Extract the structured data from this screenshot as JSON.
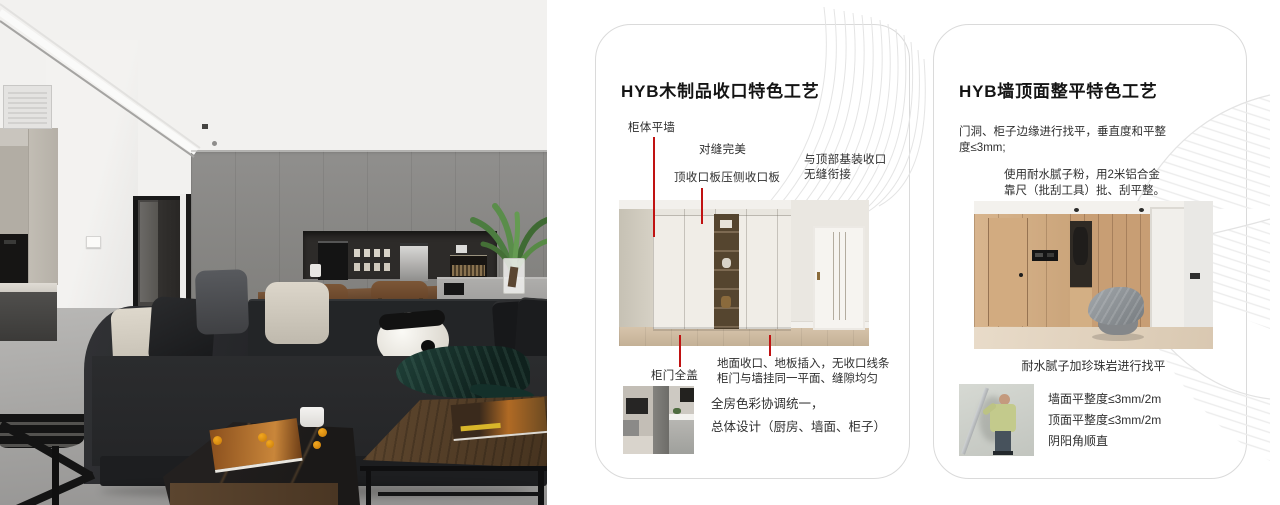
{
  "colors": {
    "accent_red": "#c01212",
    "card_border": "#dadada",
    "decor_line": "#e5e5e5"
  },
  "card1": {
    "title": "HYB木制品收口特色工艺",
    "callout_cabinet_flush_wall": "柜体平墙",
    "callout_perfect_seam": "对缝完美",
    "callout_top_closeout_panel": "顶收口板压侧收口板",
    "callout_ceiling_joint_line1": "与顶部基装收口",
    "callout_ceiling_joint_line2": "无缝衔接",
    "callout_full_overlay_door": "柜门全盖",
    "note_line1": "地面收口、地板插入，无收口线条",
    "note_line2": "柜门与墙挂同一平面、缝隙均匀",
    "summary_line1": "全房色彩协调统一，",
    "summary_line2": "总体设计（厨房、墙面、柜子）"
  },
  "card2": {
    "title": "HYB墙顶面整平特色工艺",
    "para1_line1": "门洞、柜子边缘进行找平，垂直度和平整",
    "para1_line2": "度≤3mm;",
    "para2_line1": "使用耐水腻子粉，用2米铝合金",
    "para2_line2": "靠尺（批刮工具）批、刮平整。",
    "photo_caption": "耐水腻子加珍珠岩进行找平",
    "spec_wall": "墙面平整度≤3mm/2m",
    "spec_ceiling": "顶面平整度≤3mm/2m",
    "spec_corner": "阴阳角顺直"
  }
}
